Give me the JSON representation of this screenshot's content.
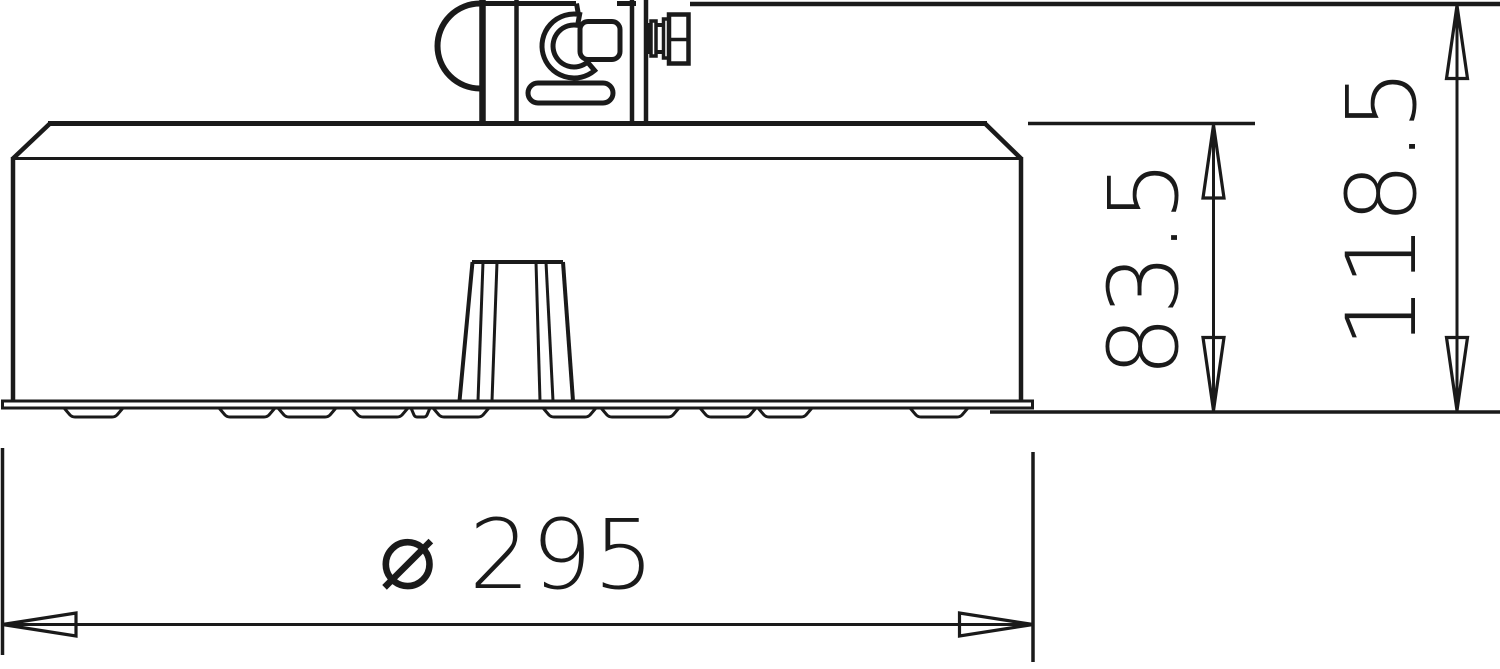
{
  "drawing": {
    "background": "#ffffff",
    "line_color": "#1a1a1a",
    "description": "side elevation of round conductor-holder base with clamp",
    "dimensions": {
      "diameter": {
        "label": "⌀ 295",
        "value": 295
      },
      "base_height": {
        "label": "83.5",
        "value": 83.5
      },
      "total_height": {
        "label": "118.5",
        "value": 118.5
      }
    }
  }
}
